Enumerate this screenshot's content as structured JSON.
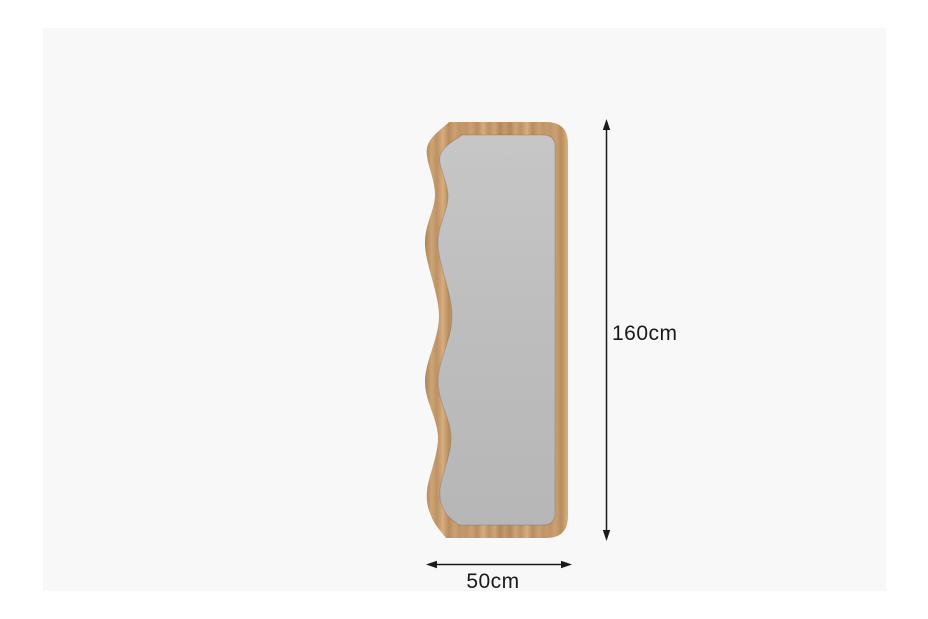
{
  "page": {
    "background": "#ffffff",
    "canvas_background": "#f8f8f8"
  },
  "product": {
    "name": "wavy-edge wooden full-length mirror",
    "frame_color": "#c59a6b",
    "frame_color_dark": "#b3875a",
    "frame_color_light": "#d6ae7e",
    "glass_color": "#bcbcbc",
    "glass_color_top": "#c7c7c8",
    "glass_color_bottom": "#b6b6b7"
  },
  "dimensions": {
    "height_label": "160cm",
    "width_label": "50cm",
    "line_color": "#1a1a1a"
  }
}
